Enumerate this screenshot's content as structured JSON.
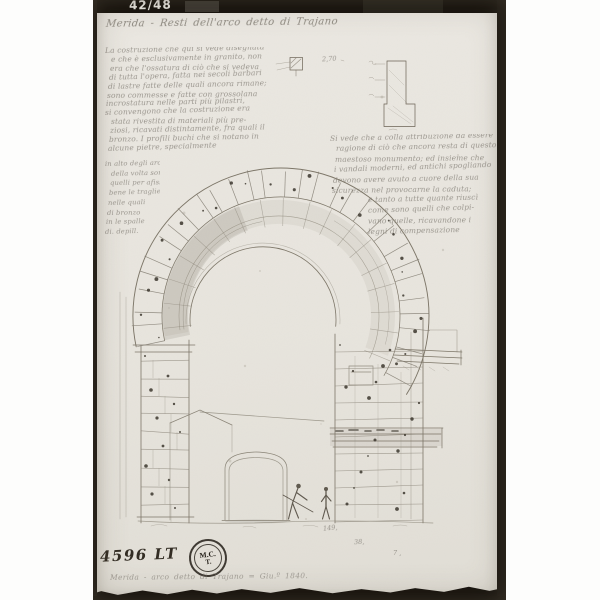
{
  "photo": {
    "plate_number": "42/48",
    "inventory_number": "4596 LT",
    "stamp": {
      "line1": "M.C.",
      "line2": "T."
    }
  },
  "title": "Merida - Resti dell'arco detto di Trajano",
  "caption": "Merida - arco detto di Trajano  =  Giu.º 1840.",
  "measurements": {
    "profile": "2,70",
    "bottom_1": "149,",
    "bottom_2": "38,",
    "bottom_3": "7 ,"
  },
  "left_text": {
    "upper": [
      "La costruzione che qui si vede disegnata",
      "e che è esclusivamente in granito, non",
      "era che l'ossatura di ciò che si vedeva",
      "di tutta l'opera, fatta nei secoli barbari",
      "di lastre fatte delle quali ancora rimane;",
      "sono commesse e fatte con grossolana",
      "incrostatura nelle parti più pilastri,",
      "si convengono che la costruzione era",
      "stata rivestita di materiali più pre-",
      "ziosi, ricavati distintamente, fra quali il",
      "bronzo. I profili buchi che si notano in",
      "alcune pietre, specialmente"
    ],
    "margin": [
      "in alto degli archi",
      "della volta sono",
      "quelli per afissar",
      "bene le traglie",
      "nelle quali",
      "di bronzo",
      "in le spalle",
      "di. depill."
    ]
  },
  "right_text": {
    "lines": [
      "Si vede che a colla attribuzione da essere",
      "ragione di ciò che ancora resta di questo",
      "maestoso monumento; ed insieme che",
      "i vandali moderni, ed antichi spogliando",
      "devono avere avuto a cuore della sua",
      "sicurezza nel provocarne la caduta;",
      "e tanto a tutte quante riuscì",
      "come sono quelli che colpi-",
      "vano quelle, ricavandone i",
      "legni di compensazione"
    ]
  },
  "palette": {
    "paper": "#e8e5de",
    "photo_border": "#16120d",
    "graphite": "#8b8579",
    "ink": "#2b2620"
  }
}
